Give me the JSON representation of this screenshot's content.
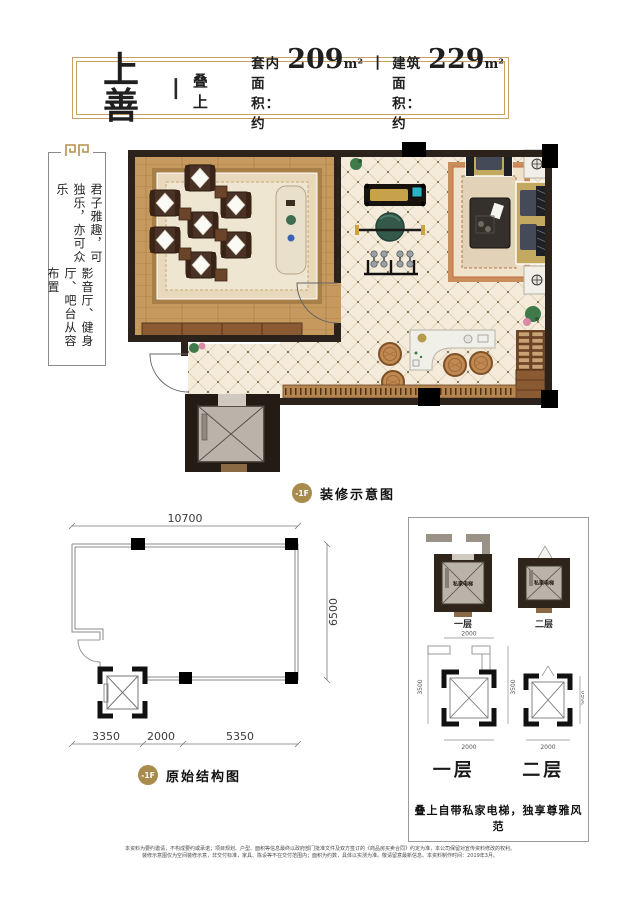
{
  "colors": {
    "gold_border": "#c9a063",
    "badge_gold": "#a98b4e",
    "wall": "#2b231b",
    "wood_floor": "#c69a5f",
    "tile_floor": "#f4ebda",
    "ink": "#1f1f1f"
  },
  "header": {
    "title": "上善",
    "divider": "丨",
    "tag": "叠上",
    "indoor_label": "套内面积：约",
    "indoor_value": "209",
    "indoor_unit": "m²",
    "separator": "丨",
    "building_label": "建筑面积：约",
    "building_value": "229",
    "building_unit": "m²"
  },
  "side_note": {
    "column1": "君子雅趣，可独乐，亦可众乐",
    "column2": "影音厅、健身厅、吧台从容布置"
  },
  "decorated_plan": {
    "badge": "-1F",
    "caption": "装修示意图"
  },
  "structural_plan": {
    "badge": "-1F",
    "caption": "原始结构图",
    "dim_top": "10700",
    "dim_right": "6500",
    "dim_bottom": [
      "3350",
      "2000",
      "5350"
    ]
  },
  "elevator_panel": {
    "decorated": [
      {
        "cab_text": "私家电梯",
        "label": "一层"
      },
      {
        "cab_text": "私家电梯",
        "label": "二层"
      }
    ],
    "structural_first": {
      "dim_top": "2000",
      "dim_left": "3500",
      "dim_right": "3500",
      "dim_bottom": "2000",
      "label": "一层"
    },
    "structural_second": {
      "dim_right": "2050",
      "dim_bottom": "2000",
      "label": "二层"
    },
    "tagline": "叠上自带私家电梯，独享尊雅风范"
  },
  "footer": {
    "line1": "本资料为要约邀请，不构成要约或承诺；项目规划、户型、面积等信息最终以政府部门批准文件及双方签订的《商品房买卖合同》约定为准，本公司保留对宣传资料修改的权利。",
    "line2": "装修示意图仅为空间装修示意，非交付标准，家具、陈设等不在交付范围内；面积为约数，具体以实测为准。敬请留意最新信息。本资料制作时间：2019年3月。"
  }
}
